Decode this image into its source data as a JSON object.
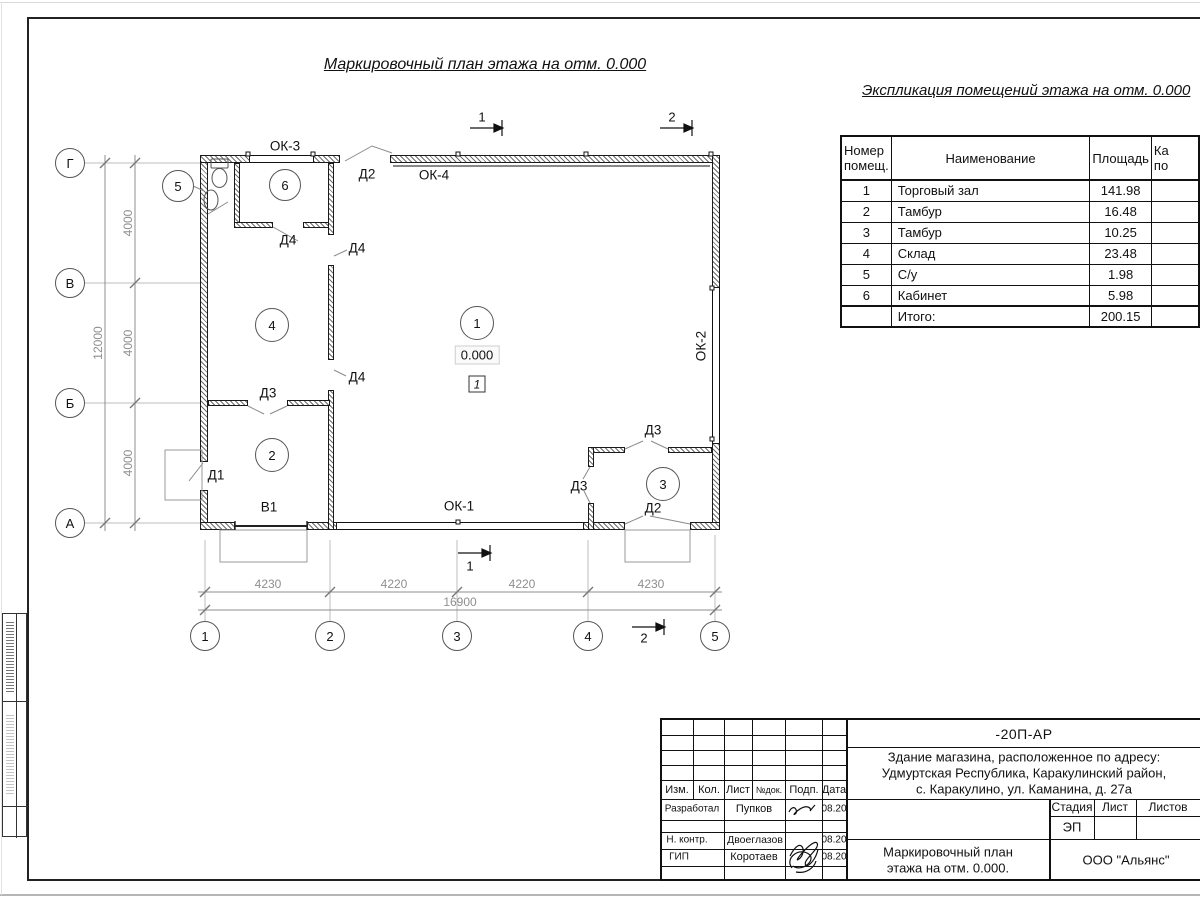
{
  "titles": {
    "plan": "Маркировочный план этажа на отм. 0.000",
    "explication": "Экспликация помещений этажа на отм. 0.000"
  },
  "explication": {
    "col_num_l1": "Номер",
    "col_num_l2": "помещ.",
    "col_name": "Наименование",
    "col_area": "Площадь",
    "col4_l1": "Ка",
    "col4_l2": "по",
    "rows": [
      {
        "num": "1",
        "name": "Торговый зал",
        "area": "141.98"
      },
      {
        "num": "2",
        "name": "Тамбур",
        "area": "16.48"
      },
      {
        "num": "3",
        "name": "Тамбур",
        "area": "10.25"
      },
      {
        "num": "4",
        "name": "Склад",
        "area": "23.48"
      },
      {
        "num": "5",
        "name": "С/у",
        "area": "1.98"
      },
      {
        "num": "6",
        "name": "Кабинет",
        "area": "5.98"
      }
    ],
    "total_label": "Итого:",
    "total_area": "200.15"
  },
  "plan": {
    "row_axes": [
      "Г",
      "В",
      "Б",
      "А"
    ],
    "col_axes": [
      "1",
      "2",
      "3",
      "4",
      "5"
    ],
    "rooms": [
      "1",
      "2",
      "3",
      "4",
      "5",
      "6"
    ],
    "elevation": "0.000",
    "floor_mark": "1",
    "labels": {
      "ok1": "ОК-1",
      "ok2": "ОК-2",
      "ok3": "ОК-3",
      "ok4": "ОК-4",
      "d1": "Д1",
      "d2": "Д2",
      "d3": "Д3",
      "d4": "Д4",
      "v1": "В1"
    },
    "dims_bottom": [
      "4230",
      "4220",
      "4220",
      "4230"
    ],
    "dim_bottom_total": "16900",
    "dims_left": [
      "4000",
      "4000",
      "4000"
    ],
    "dim_left_total": "12000",
    "section1": "1",
    "section2": "2"
  },
  "title_block": {
    "doc_number": "-20П-АР",
    "address_l1": "Здание магазина, расположенное по адресу:",
    "address_l2": "Удмуртская Республика, Каракулинский район,",
    "address_l3": "с. Каракулино, ул. Каманина, д. 27а",
    "cols": {
      "izm": "Изм.",
      "kol": "Кол.",
      "list": "Лист",
      "ndok": "№док.",
      "podp": "Подп.",
      "data": "Дата"
    },
    "stage_label": "Стадия",
    "sheet_label": "Лист",
    "sheets_label": "Листов",
    "stage": "ЭП",
    "rows": [
      {
        "role": "Разработал",
        "name": "Пупков",
        "date": "08.20"
      },
      {
        "role": "Н. контр.",
        "name": "Двоеглазов",
        "date": "08.20"
      },
      {
        "role": "ГИП",
        "name": "Коротаев",
        "date": "08.20"
      }
    ],
    "name_l1": "Маркировочный план",
    "name_l2": "этажа на отм. 0.000.",
    "company": "ООО \"Альянс\""
  }
}
